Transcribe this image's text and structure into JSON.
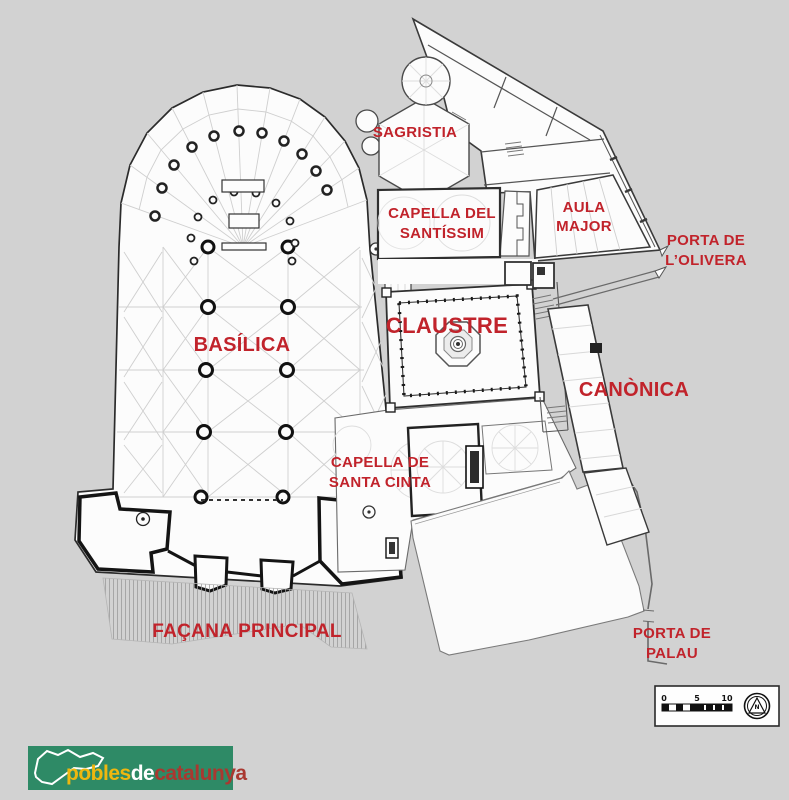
{
  "labels": {
    "sagristia": "SAGRISTIA",
    "capella_santissim_line1": "CAPELLA DEL",
    "capella_santissim_line2": "SANTÍSSIM",
    "aula_major_line1": "AULA",
    "aula_major_line2": "MAJOR",
    "porta_olivera_line1": "PORTA DE",
    "porta_olivera_line2": "L’OLIVERA",
    "claustre": "CLAUSTRE",
    "basilica": "BASÍLICA",
    "canonica": "CANÒNICA",
    "capella_cinta_line1": "CAPELLA DE",
    "capella_cinta_line2": "SANTA CINTA",
    "facana": "FAÇANA PRINCIPAL",
    "porta_palau_line1": "PORTA DE",
    "porta_palau_line2": "PALAU"
  },
  "scale_bar": {
    "tick0": "0",
    "tick5": "5",
    "tick10": "10"
  },
  "compass": {
    "letter": "N"
  },
  "watermark": {
    "part1": "pobles",
    "part2": "de",
    "part3": "catalunya"
  },
  "colors": {
    "background": "#d2d2d2",
    "plan_fill": "#fcfcfc",
    "wall_dark": "#2b2b2b",
    "rib_light": "#cfcfcf",
    "label_red": "#c1232b",
    "logo_green": "#2e8a66",
    "logo_yellow": "#efb70f",
    "logo_red": "#a93830"
  }
}
